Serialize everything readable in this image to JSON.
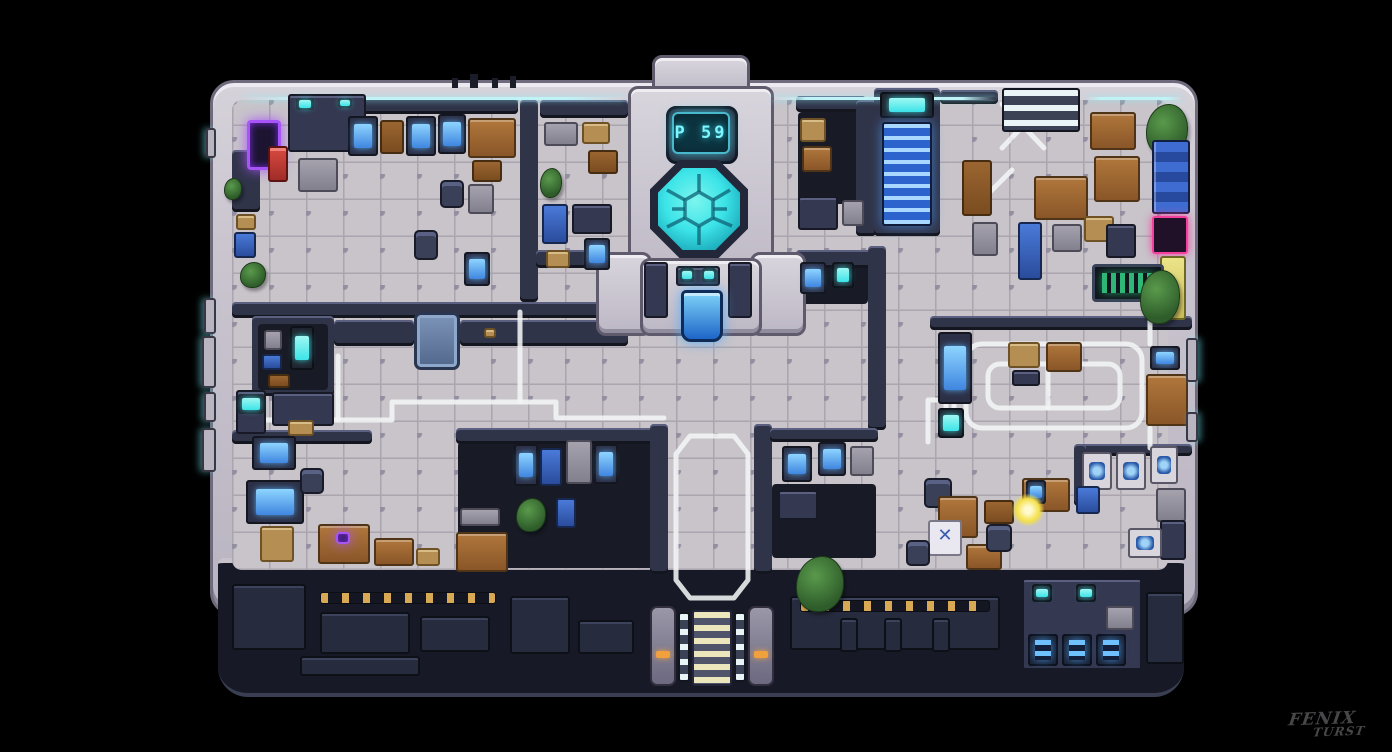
{
  "scene": {
    "background": "#000000"
  },
  "tower": {
    "display_text": "P 59"
  },
  "signature": {
    "line1": "FENIX",
    "line2": "TURST"
  },
  "palette": {
    "bg": "#000000",
    "hull": "#cac5cf",
    "hull_hi": "#eceaf0",
    "hull_dark": "#8d8898",
    "wall": "#303449",
    "wall_hi": "#5c6182",
    "wall_dark": "#14161f",
    "floor": "#c8c4ca",
    "grout": "#aaa5af",
    "grout_dot": "#948fa0",
    "dark_floor": "#181b26",
    "underbelly": "#171a26",
    "cyan": "#3ce4e8",
    "cyan_soft": "#bff3f6",
    "blue_screen": "#3f86e0",
    "stair_blue": "#2d63cc",
    "wood": "#a26c36",
    "path_white": "#f2f5f5",
    "orange": "#f0a03c",
    "neon_purple": "#a855f7",
    "neon_pink": "#f43f9e",
    "cream": "#ece6bc",
    "green_text": "#35d488",
    "glow_yellow": "#f4e04a"
  }
}
